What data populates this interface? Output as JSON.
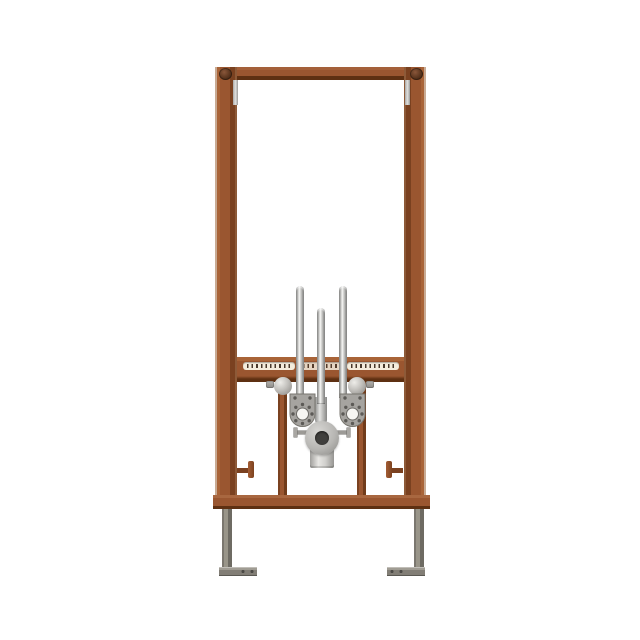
{
  "meta": {
    "type": "product-render",
    "subject": "In-wall bidet installation frame, front view, on white background",
    "background": "#ffffff"
  },
  "colors": {
    "frame": "#9a5630",
    "frame_light": "#a96438",
    "frame_dark": "#7a4120",
    "frame_darker": "#5e3012",
    "frame_edge_light": "#c9ab94",
    "bolt_dark": "#53301a",
    "slot_bg": "#f4ecdc",
    "tooth": "#47372a",
    "ball_hi": "#eeede9",
    "steel": "#999589",
    "steel_dark": "#6e6b63",
    "plate": "#a6a4a0",
    "plate_hole": "#5c5a56",
    "pipe_mid": "#d0cfcc",
    "drain_hole": "#403f3d"
  },
  "parts": {
    "stage": "Bidet installation frame product image",
    "top_crossbar": "Top crossbar",
    "corner_bolt_left": "Top-left corner bolt",
    "corner_bolt_right": "Top-right corner bolt",
    "left_upright": "Left upright rail",
    "right_upright": "Right upright rail",
    "anchor_left": "Left wall-anchor slot",
    "anchor_right": "Right wall-anchor slot",
    "rod_left": "Left threaded mounting rod",
    "rod_middle": "Middle water-inlet rod",
    "rod_right": "Right threaded mounting rod",
    "adjustment_rail": "Toothed height-adjustment rail",
    "slot_left": "Left toothed slot",
    "slot_center": "Center toothed slot",
    "slot_right": "Right toothed slot",
    "carriage_bar_left": "Left carriage bar",
    "carriage_bar_right": "Right carriage bar",
    "ball_left": "Left locking ball knob",
    "ball_right": "Right locking ball knob",
    "ball_bolt_left": "Left locking bolt",
    "ball_bolt_right": "Right locking bolt",
    "plate_left": "Left perforated mounting plate",
    "plate_right": "Right perforated mounting plate",
    "connector": "Chrome drain connector",
    "drain_outlet": "Drain outlet fitting",
    "wing_left": "Left clamp wing screw",
    "wing_right": "Right clamp wing screw",
    "drain_pipe": "Drain pipe stub",
    "bottom_crossbar": "Bottom crossbar",
    "knob_left": "Left depth-adjuster knob",
    "knob_right": "Right depth-adjuster knob",
    "leg_left": "Left foot leg",
    "leg_right": "Right foot leg",
    "foot_plate_left": "Left foot plate",
    "foot_plate_right": "Right foot plate"
  }
}
